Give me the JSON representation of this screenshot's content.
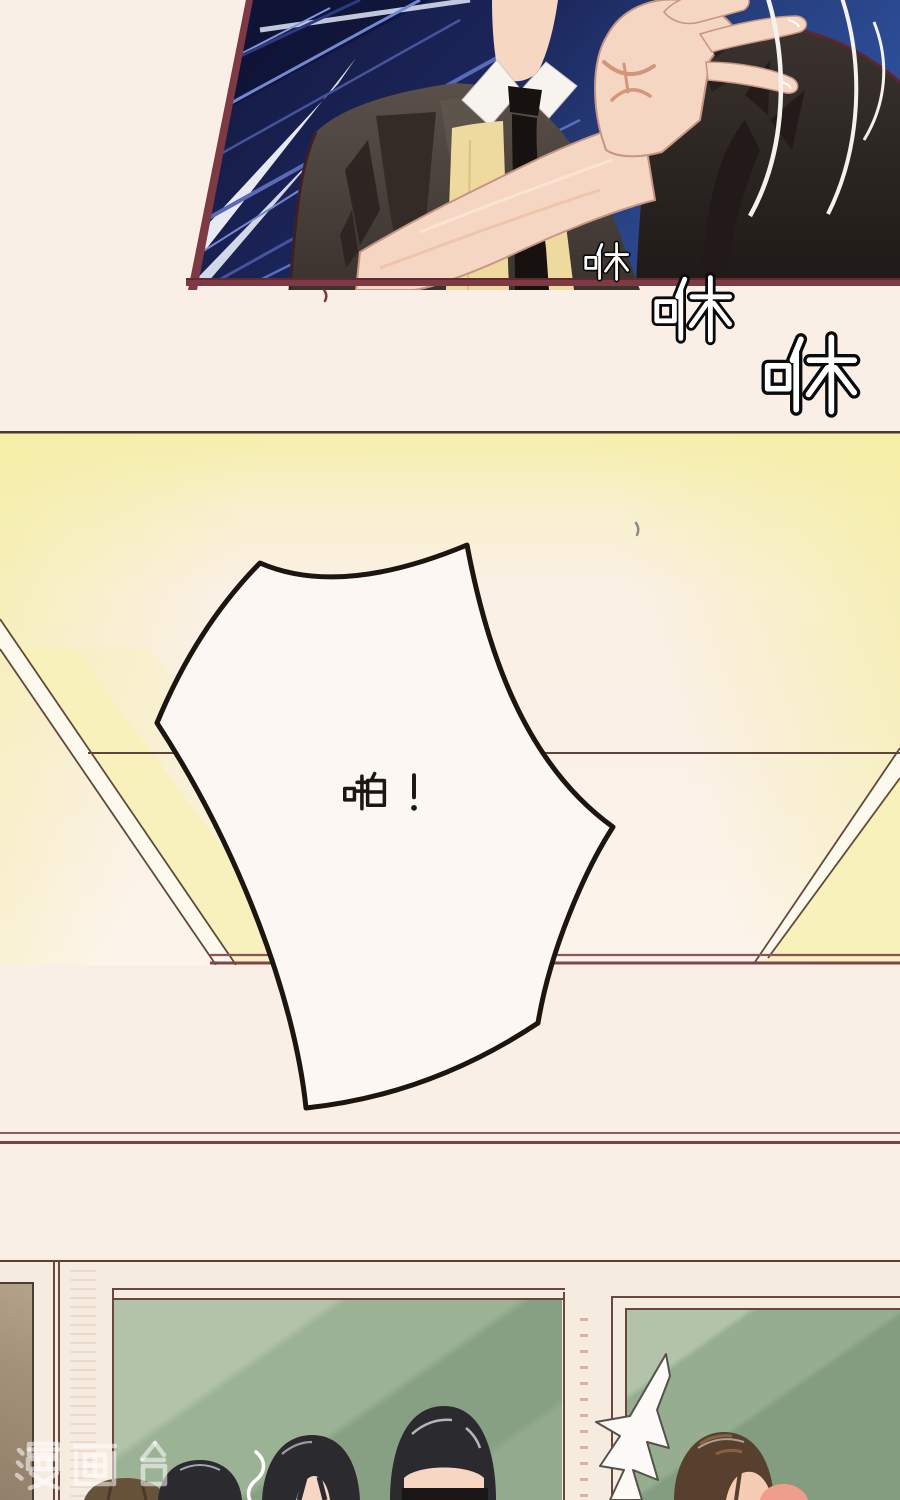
{
  "page": {
    "width": 900,
    "height": 1500,
    "background": "#faefe7",
    "type": "manhua-comic-page"
  },
  "sfx": {
    "swish_1": {
      "text": "咻",
      "size_px": 46,
      "style": "white-fill-black-outline"
    },
    "swish_2": {
      "text": "咻",
      "size_px": 73,
      "style": "white-fill-black-outline"
    },
    "swish_3": {
      "text": "咻",
      "size_px": 95,
      "style": "white-fill-black-outline"
    },
    "slap": {
      "text": "啪！",
      "size_px": 46,
      "color": "#1c1713"
    }
  },
  "watermark": {
    "text": "漫画台",
    "color": "#ffffff",
    "opacity": 0.55
  },
  "panels": {
    "top_action": {
      "description": "close-up: raised open hand in front of a suited figure, navy speed-line background",
      "sky_dark": "#11163a",
      "sky_light": "#2e4f9c",
      "border": "#7b3a44",
      "suit": "#4f463f",
      "skin": "#f5d6c2",
      "shirt": "#f7f4ef",
      "tie": "#17120f",
      "sweater": "#eeda9f"
    },
    "middle_impact": {
      "description": "pale yellow ceiling in perspective with large impact speech bubble",
      "ceiling_yellow": "#f5eea5",
      "line_dark": "#5c463c",
      "line_maroon": "#8f525a",
      "bubble_fill": "#fcf7f2",
      "bubble_stroke": "#1d150f"
    },
    "bottom_classroom": {
      "description": "classroom wall with green windows and backs of students' heads",
      "wall": "#f6ebdf",
      "door_tan": "#9d8a72",
      "glass_light": "#b2c3a9",
      "glass_mid": "#9cb295",
      "glass_dark": "#87a083",
      "hair_black": "#2b2a2e",
      "hair_brown": "#57402d",
      "hair_olive": "#66533a",
      "burst_fill": "#fdfbf7",
      "skin": "#f7d6c3"
    }
  }
}
